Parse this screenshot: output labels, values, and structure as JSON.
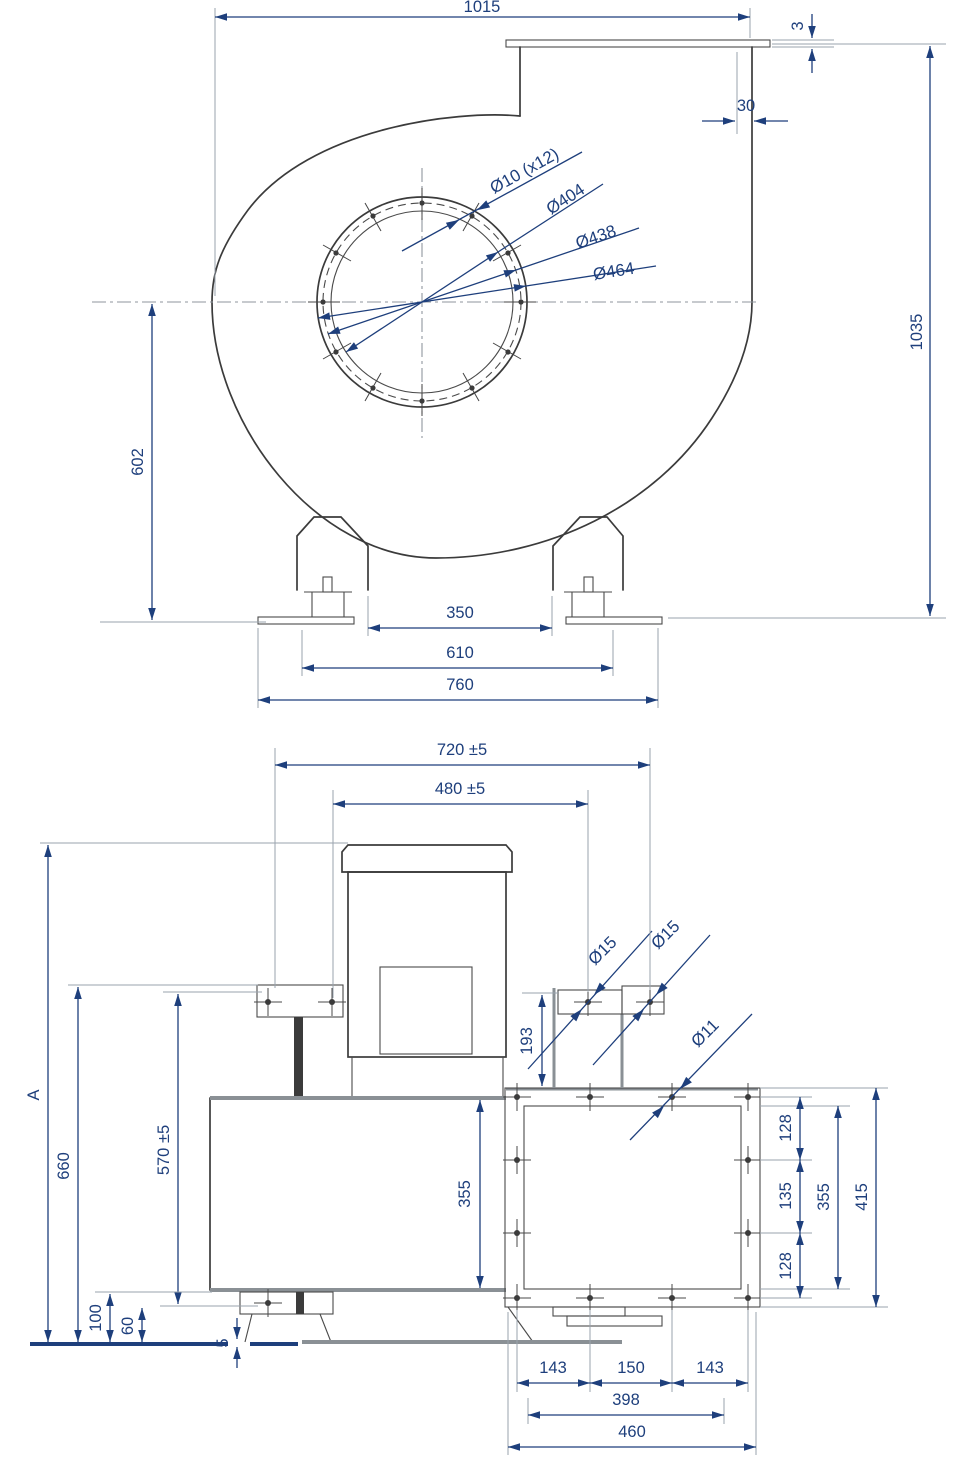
{
  "front": {
    "overall_width": "1015",
    "flange_lip": "3",
    "outlet_offset": "30",
    "overall_height": "1035",
    "axis_height": "602",
    "feet_gap": "350",
    "feet_pitch": "610",
    "base_width": "760",
    "bolt_holes": "Ø10  (x12)",
    "dia_inner": "Ø404",
    "dia_bolt_circle": "Ø438",
    "dia_outer": "Ø464"
  },
  "side": {
    "span_720": "720 ±5",
    "span_480": "480 ±5",
    "height_A": "A",
    "height_660": "660",
    "height_570": "570 ±5",
    "base_100": "100",
    "base_60": "60",
    "plate_5": "5",
    "inlet_height_193": "193",
    "housing_355": "355",
    "dia_15_left": "Ø15",
    "dia_15_right": "Ø15",
    "dia_11": "Ø11",
    "flange_128_top": "128",
    "flange_135": "135",
    "flange_128_bottom": "128",
    "flange_355": "355",
    "flange_415": "415",
    "bottom_143_left": "143",
    "bottom_150": "150",
    "bottom_143_right": "143",
    "bottom_398": "398",
    "bottom_460": "460"
  },
  "colors": {
    "dimension": "#1e3f7c",
    "line": "#3b3b3b",
    "plate": "#8a9095"
  }
}
